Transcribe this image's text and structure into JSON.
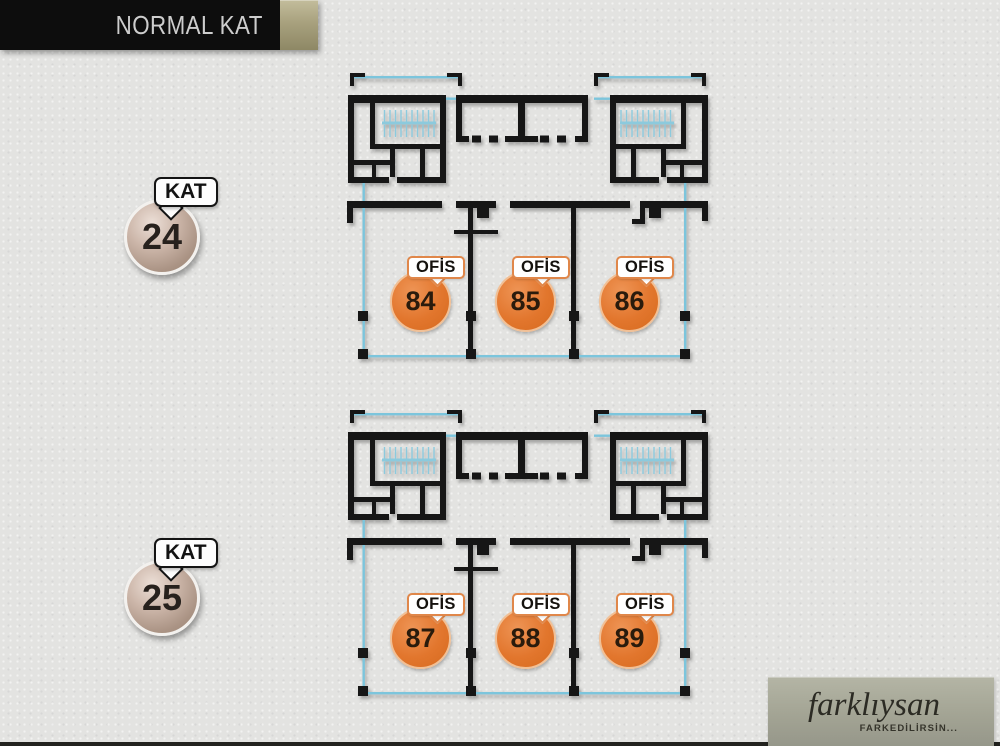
{
  "header": {
    "title": "NORMAL KAT"
  },
  "floors": [
    {
      "kat_label": "KAT",
      "floor_number": "24",
      "offices": [
        {
          "label": "OFİS",
          "number": "84"
        },
        {
          "label": "OFİS",
          "number": "85"
        },
        {
          "label": "OFİS",
          "number": "86"
        }
      ]
    },
    {
      "kat_label": "KAT",
      "floor_number": "25",
      "offices": [
        {
          "label": "OFİS",
          "number": "87"
        },
        {
          "label": "OFİS",
          "number": "88"
        },
        {
          "label": "OFİS",
          "number": "89"
        }
      ]
    }
  ],
  "logo": {
    "brand": "farklıysan",
    "tagline": "FARKEDİLİRSİN..."
  },
  "colors": {
    "wall_black": "#161616",
    "plan_cyan": "#7cc5dc",
    "office_orange": "#e2762d",
    "header_bg": "#0d0d0d",
    "header_text": "#cdcdcd",
    "header_chip_gold": "#a8a17e",
    "logo_bg": "#a3a494",
    "floor_badge_metal": "#b49c8e",
    "background": "#e3e3e1"
  }
}
